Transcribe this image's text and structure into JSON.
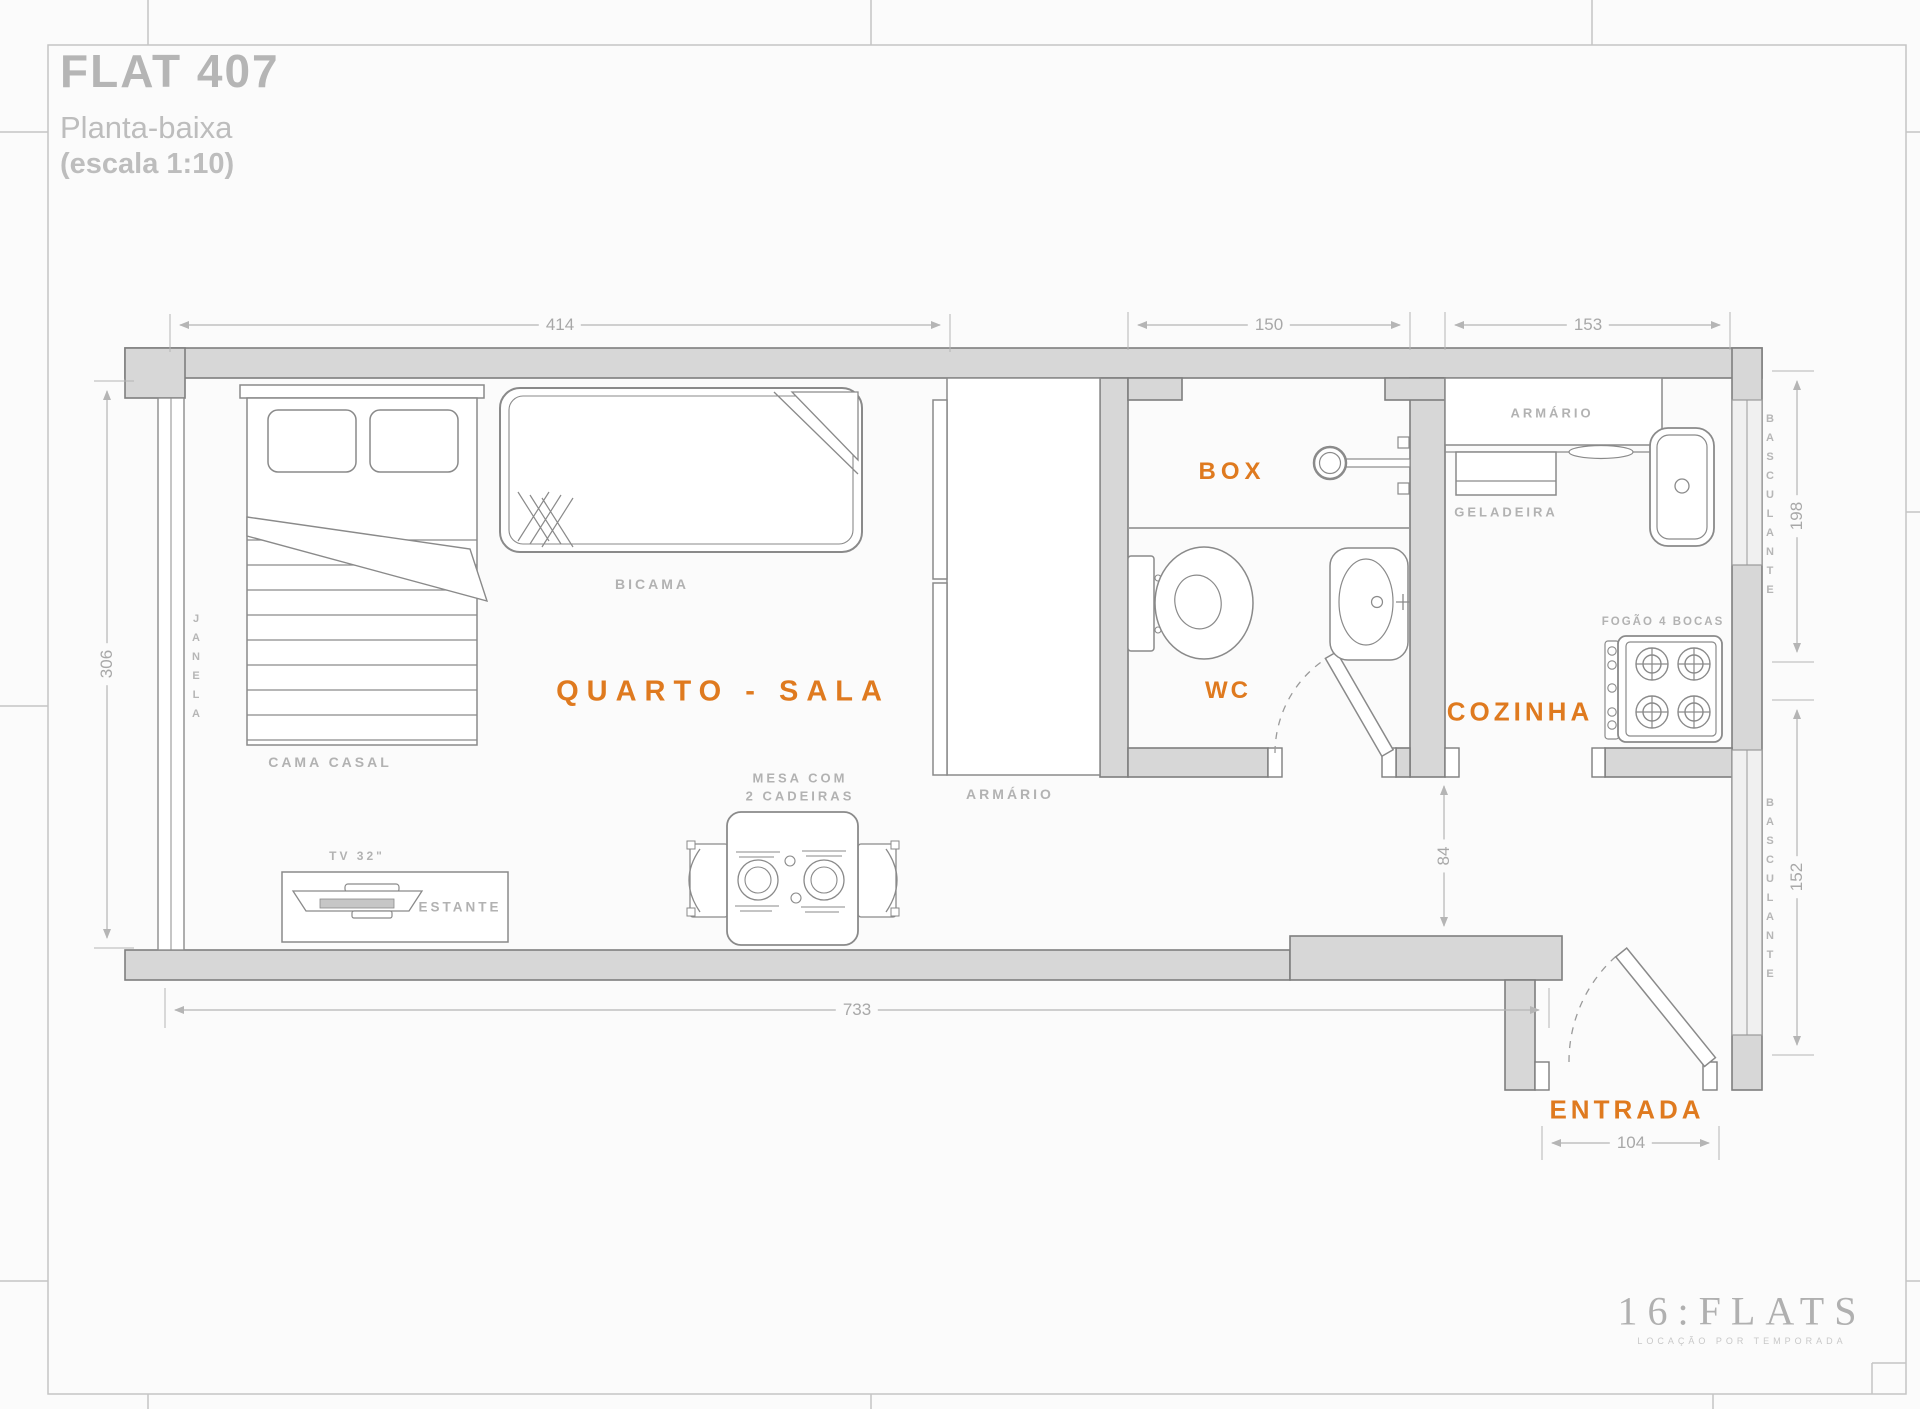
{
  "title": {
    "flat": "FLAT 407",
    "subtitle": "Planta-baixa",
    "scale": "(escala 1:10)"
  },
  "rooms": {
    "quarto_sala": "QUARTO - SALA",
    "box": "BOX",
    "wc": "WC",
    "cozinha": "COZINHA",
    "entrada": "ENTRADA"
  },
  "furniture": {
    "bicama": "BICAMA",
    "cama_casal": "CAMA CASAL",
    "armario_quarto": "ARMÁRIO",
    "armario_cozinha": "ARMÁRIO",
    "geladeira": "GELADEIRA",
    "fogao": "FOGÃO 4 BOCAS",
    "mesa_linha1": "MESA COM",
    "mesa_linha2": "2 CADEIRAS",
    "tv": "TV 32\"",
    "estante": "ESTANTE",
    "janela": "JANELA",
    "basculante_superior": "BASCULANTE",
    "basculante_inferior": "BASCULANTE"
  },
  "dimensions": {
    "quarto_largura": "414",
    "wc_largura": "150",
    "cozinha_largura": "153",
    "quarto_altura": "306",
    "total_largura": "733",
    "entrada_largura": "104",
    "cozinha_altura": "198",
    "corredor_altura": "152",
    "passagem_altura": "84"
  },
  "logo": {
    "brand": "16:FLATS",
    "tagline": "LOCAÇÃO POR TEMPORADA"
  },
  "colors": {
    "accent": "#DF7A1F",
    "wall_fill": "#D7D7D7",
    "wall_stroke": "#7E7E7E",
    "furniture_stroke": "#8A8A8A",
    "dim_line": "#B5B5B5",
    "label_gray": "#B2B2B2"
  }
}
